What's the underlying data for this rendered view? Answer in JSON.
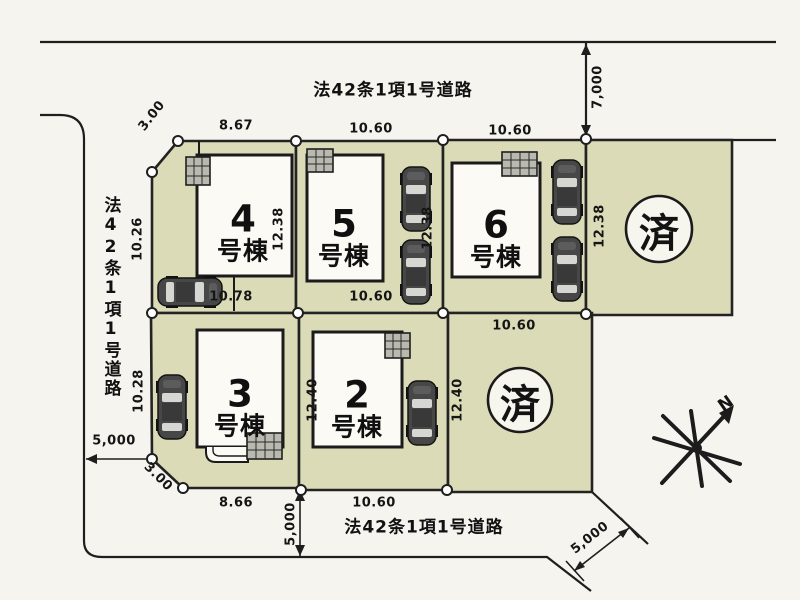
{
  "roads": {
    "top_label": "法42条1項1号道路",
    "left_label": "法42条1項1号道路",
    "bottom_label": "法42条1項1号道路"
  },
  "lots": {
    "lot4": {
      "num": "4",
      "suffix": "号棟"
    },
    "lot5": {
      "num": "5",
      "suffix": "号棟"
    },
    "lot6": {
      "num": "6",
      "suffix": "号棟"
    },
    "lot3": {
      "num": "3",
      "suffix": "号棟"
    },
    "lot2": {
      "num": "2",
      "suffix": "号棟"
    },
    "sold_top": {
      "label": "済"
    },
    "sold_bottom": {
      "label": "済"
    }
  },
  "dims": {
    "top_lot4": "8.67",
    "top_lot5": "10.60",
    "top_lot6": "10.60",
    "right_road": "7,000",
    "corner_nw": "3.00",
    "left_lot4": "10.26",
    "right_lot4": "12.38",
    "right_lot5": "12.38",
    "right_lot6": "12.38",
    "bottom_lot4": "10.78",
    "bottom_lot5": "10.60",
    "top_sold_bottom": "10.60",
    "left_lot3": "10.28",
    "left_lot2": "12.40",
    "right_lot2": "12.40",
    "left_road": "5,000",
    "corner_sw": "3.00",
    "bottom_lot3": "8.66",
    "bottom_lot2": "10.60",
    "bottom_road": "5,000",
    "bottom_right_road": "5,000"
  },
  "compass": {
    "label": "N"
  }
}
